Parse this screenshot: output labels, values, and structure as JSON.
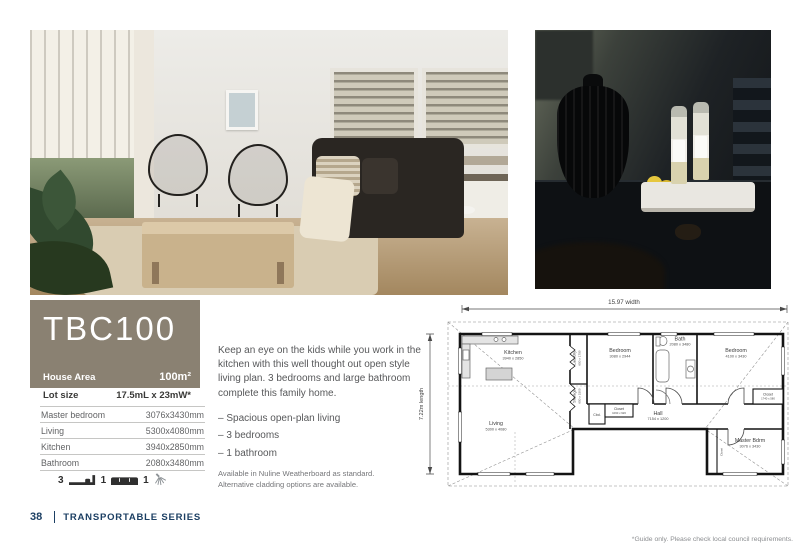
{
  "colors": {
    "accent": "#8a8172",
    "navy": "#1c3f63"
  },
  "model": {
    "name": "TBC100"
  },
  "house_area": {
    "label": "House Area",
    "value": "100m²"
  },
  "lot_size": {
    "label": "Lot size",
    "value": "17.5mL x 23mW*"
  },
  "spec_table": {
    "rows": [
      {
        "label": "Master bedroom",
        "value": "3076x3430mm"
      },
      {
        "label": "Living",
        "value": "5300x4080mm"
      },
      {
        "label": "Kitchen",
        "value": "3940x2850mm"
      },
      {
        "label": "Bathroom",
        "value": "2080x3480mm"
      }
    ]
  },
  "features": {
    "bedrooms": "3",
    "living_rooms": "1",
    "bathrooms": "1"
  },
  "description": {
    "paragraph": "Keep an eye on the kids while you work in the kitchen with this well thought out open style living plan. 3 bedrooms and large bathroom complete this family home.",
    "bullets": [
      "–  Spacious open-plan living",
      "–  3 bedrooms",
      "–  1 bathroom"
    ],
    "note_line1": "Available in Nuline Weatherboard as standard.",
    "note_line2": "Alternative cladding options are available."
  },
  "floor_plan": {
    "width_label": "15.97 width",
    "length_label": "7.22m length",
    "rooms": {
      "kitchen": {
        "name": "Kitchen",
        "dims": "3940 x 2850"
      },
      "laundry": {
        "name": "Laundry",
        "dims": "650 x 1750"
      },
      "storage": {
        "name": "Storage",
        "dims": "650 x 1500"
      },
      "bedroom_mid": {
        "name": "Bedroom",
        "dims": "3080 x 2944"
      },
      "bath": {
        "name": "Bath",
        "dims": "2080 x 3480"
      },
      "bedroom_right": {
        "name": "Bedroom",
        "dims": "4100 x 3430"
      },
      "cbd": {
        "name": "Cbd."
      },
      "closet_hall": {
        "name": "Closet",
        "dims": "1060 x 926"
      },
      "closet_right": {
        "name": "Closet",
        "dims": "1740 x 580"
      },
      "hall": {
        "name": "Hall",
        "dims": "7154 x 1200"
      },
      "living": {
        "name": "Living",
        "dims": "5300 x 4080"
      },
      "master": {
        "name": "Master Bdrm",
        "dims": "3076 x 3430"
      },
      "closet_master": {
        "name": "Closet"
      }
    }
  },
  "footer": {
    "page_number": "38",
    "series_title": "TRANSPORTABLE SERIES",
    "disclaimer": "*Guide only. Please check local council requirements."
  }
}
